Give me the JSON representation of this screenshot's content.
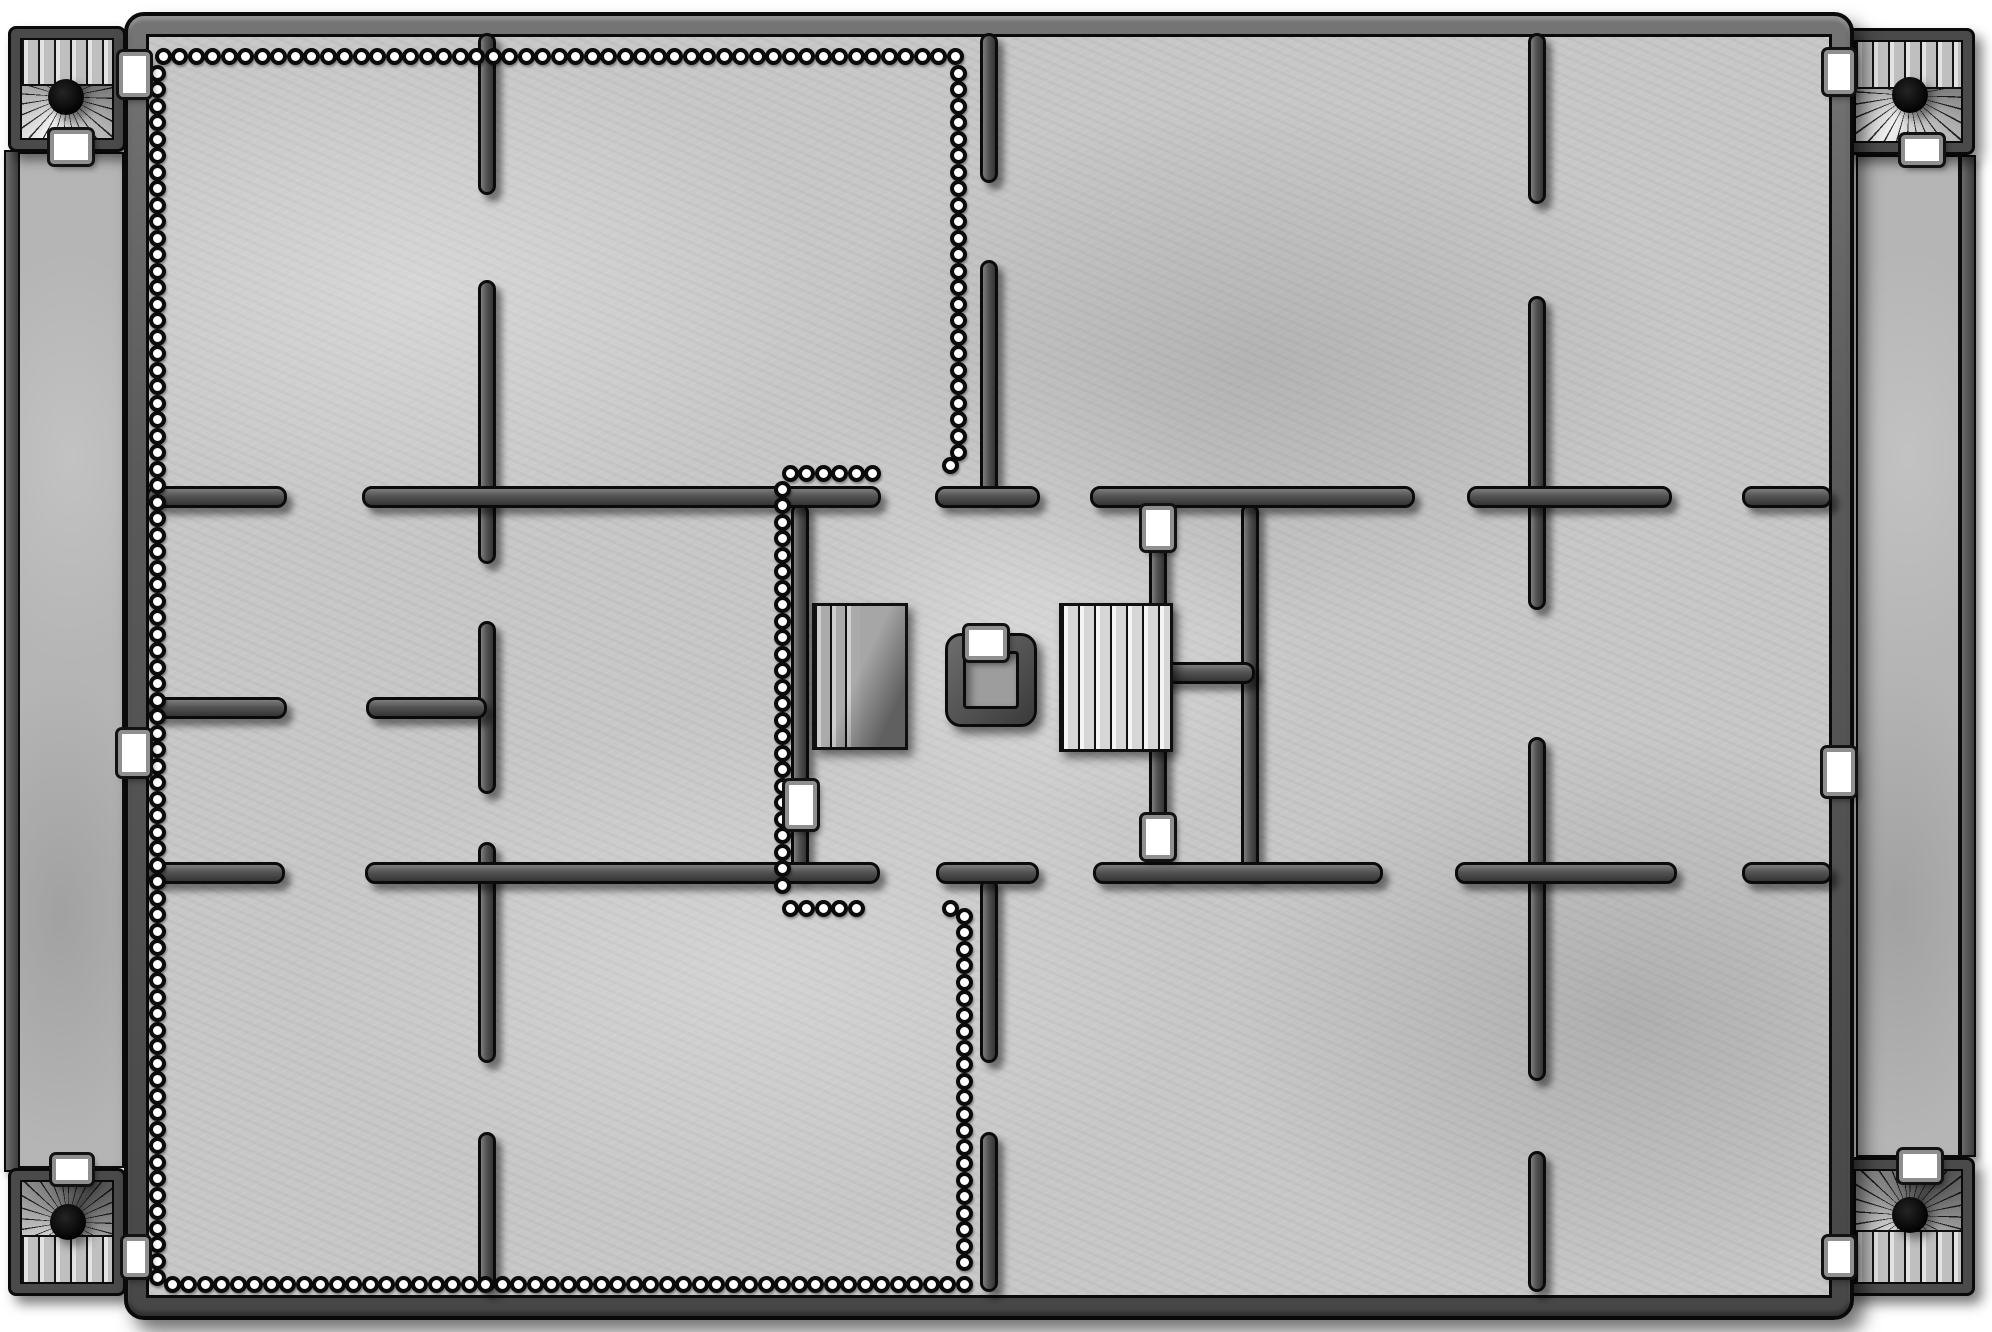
{
  "title": "stone-dungeon-floorplan-battle-map",
  "canvas": {
    "w": 1992,
    "h": 1332,
    "bg": "#ffffff"
  },
  "palette": {
    "floor": "#c7c7c7",
    "corridor_floor": "#b5b5b5",
    "wall_fill": "#535353",
    "frame_fill": "#5a5a5a",
    "outline": "#0a0a0a",
    "bead_fill": "#ffffff",
    "door_fill": "#ffffff",
    "door_frame": "#8f8f8f",
    "stair_light": "#e8e8e8",
    "stair_dark": "#b0b0b0",
    "well_floor": "#9d9d9d"
  },
  "frame": {
    "outer": [
      124,
      12,
      1730,
      1308
    ],
    "floor": [
      146,
      34,
      1686,
      1264
    ]
  },
  "light_zone": [
    762,
    350,
    505,
    560
  ],
  "corridors": [
    {
      "side": "left",
      "wall": [
        4,
        150,
        16,
        1022
      ],
      "floor": [
        18,
        152,
        106,
        1016
      ]
    },
    {
      "side": "right",
      "wall": [
        1960,
        155,
        16,
        1002
      ],
      "floor": [
        1856,
        155,
        104,
        1002
      ]
    }
  ],
  "corner_rooms": [
    {
      "corner": "top-left",
      "box": [
        8,
        26,
        118,
        126
      ],
      "dot": [
        49,
        58
      ],
      "band": "top"
    },
    {
      "corner": "top-right",
      "box": [
        1842,
        28,
        133,
        127
      ],
      "dot": [
        51,
        54
      ],
      "band": "top"
    },
    {
      "corner": "bottom-left",
      "box": [
        8,
        1168,
        118,
        128
      ],
      "dot": [
        51,
        40
      ],
      "band": "bottom"
    },
    {
      "corner": "bottom-right",
      "box": [
        1842,
        1157,
        133,
        139
      ],
      "dot": [
        51,
        40
      ],
      "band": "bottom"
    }
  ],
  "walls": [
    [
      478,
      33,
      18,
      162
    ],
    [
      478,
      280,
      18,
      284
    ],
    [
      478,
      621,
      18,
      173
    ],
    [
      478,
      842,
      18,
      221
    ],
    [
      478,
      1132,
      18,
      160
    ],
    [
      980,
      33,
      18,
      150
    ],
    [
      980,
      260,
      18,
      240
    ],
    [
      980,
      878,
      18,
      185
    ],
    [
      980,
      1132,
      18,
      160
    ],
    [
      1528,
      33,
      18,
      171
    ],
    [
      1528,
      296,
      18,
      314
    ],
    [
      1528,
      737,
      18,
      344
    ],
    [
      1528,
      1151,
      18,
      141
    ],
    [
      791,
      503,
      18,
      374
    ],
    [
      1149,
      503,
      18,
      374
    ],
    [
      1241,
      503,
      18,
      374
    ],
    [
      146,
      486,
      141,
      22
    ],
    [
      362,
      486,
      519,
      22
    ],
    [
      935,
      486,
      105,
      22
    ],
    [
      1090,
      486,
      325,
      22
    ],
    [
      1467,
      486,
      205,
      22
    ],
    [
      1742,
      486,
      90,
      22
    ],
    [
      146,
      697,
      141,
      22
    ],
    [
      366,
      697,
      121,
      22
    ],
    [
      1158,
      662,
      97,
      22
    ],
    [
      146,
      862,
      139,
      22
    ],
    [
      365,
      862,
      515,
      22
    ],
    [
      936,
      862,
      103,
      22
    ],
    [
      1093,
      862,
      290,
      22
    ],
    [
      1455,
      862,
      222,
      22
    ],
    [
      1742,
      862,
      90,
      22
    ]
  ],
  "bead": {
    "d": 17,
    "pitch": 16.5
  },
  "bead_runs": [
    {
      "x": 163,
      "y": 56,
      "dir": "h",
      "n": 49
    },
    {
      "x": 157,
      "y": 73,
      "dir": "v",
      "n": 74
    },
    {
      "x": 172,
      "y": 1284,
      "dir": "h",
      "n": 49
    },
    {
      "x": 958,
      "y": 73,
      "dir": "v",
      "n": 24
    },
    {
      "x": 950,
      "y": 465,
      "dir": "h",
      "n": 1
    },
    {
      "x": 964,
      "y": 916,
      "dir": "v",
      "n": 22
    },
    {
      "x": 950,
      "y": 908,
      "dir": "h",
      "n": 1
    },
    {
      "x": 790,
      "y": 473,
      "dir": "h",
      "n": 6
    },
    {
      "x": 782,
      "y": 489,
      "dir": "v",
      "n": 25
    },
    {
      "x": 790,
      "y": 908,
      "dir": "h",
      "n": 5
    }
  ],
  "stairs": [
    {
      "box": [
        812,
        603,
        96,
        147
      ],
      "variant": "dark",
      "label": "staircase-descending"
    },
    {
      "box": [
        1059,
        603,
        114,
        149
      ],
      "variant": "light",
      "label": "staircase-ascending"
    }
  ],
  "well": {
    "box": [
      945,
      633,
      92,
      94
    ],
    "door": [
      965,
      626,
      42,
      34
    ]
  },
  "doors": [
    {
      "box": [
        119,
        52,
        31,
        45
      ],
      "label": "door-left-border-top"
    },
    {
      "box": [
        118,
        730,
        32,
        46
      ],
      "label": "door-left-border-middle"
    },
    {
      "box": [
        123,
        1237,
        26,
        40
      ],
      "label": "door-left-border-bottom"
    },
    {
      "box": [
        1824,
        50,
        30,
        44
      ],
      "label": "door-right-border-top"
    },
    {
      "box": [
        1823,
        748,
        32,
        48
      ],
      "label": "door-right-border-middle"
    },
    {
      "box": [
        1824,
        1237,
        30,
        40
      ],
      "label": "door-right-border-bottom"
    },
    {
      "box": [
        50,
        130,
        42,
        34
      ],
      "label": "door-stairroom-top-left"
    },
    {
      "box": [
        1901,
        135,
        42,
        30
      ],
      "label": "door-stairroom-top-right"
    },
    {
      "box": [
        52,
        1155,
        40,
        29
      ],
      "label": "door-stairroom-bottom-left"
    },
    {
      "box": [
        1899,
        1150,
        42,
        32
      ],
      "label": "door-stairroom-bottom-right"
    },
    {
      "box": [
        785,
        781,
        32,
        48
      ],
      "label": "door-chamber-west"
    },
    {
      "box": [
        1142,
        506,
        32,
        44
      ],
      "label": "door-chamber-east-top"
    },
    {
      "box": [
        1142,
        815,
        32,
        44
      ],
      "label": "door-chamber-east-bottom"
    }
  ]
}
